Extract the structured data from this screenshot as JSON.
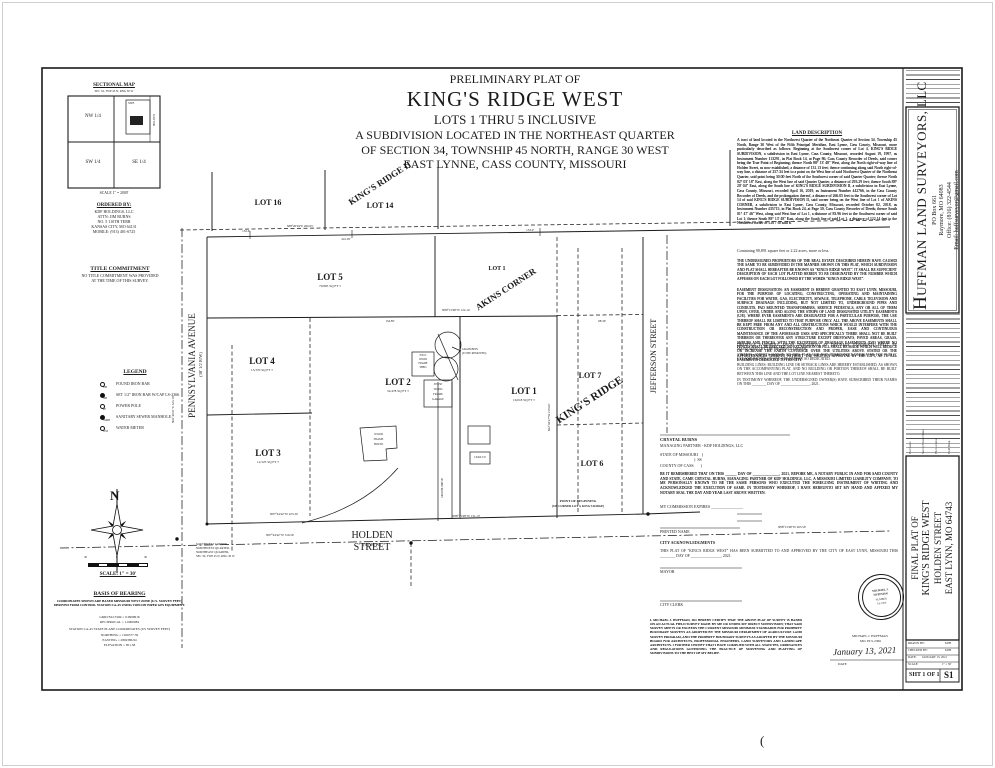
{
  "header": {
    "pre_title": "PRELIMINARY PLAT OF",
    "title": "KING'S RIDGE WEST",
    "lots_line": "LOTS 1 THRU 5 INCLUSIVE",
    "sub1": "A SUBDIVISION LOCATED IN THE NORTHEAST QUARTER",
    "sub2": "OF SECTION 34, TOWNSHIP 45 NORTH, RANGE 30 WEST",
    "sub3": "EAST LYNNE, CASS COUNTY, MISSOURI"
  },
  "sectional_map": {
    "title": "SECTIONAL MAP",
    "subtitle": "SEC 34, TWP 45 N, RNG 30 W",
    "nw": "NW 1/4",
    "sw": "SW 1/4",
    "se": "SE 1/4",
    "site": "SITE",
    "holden": "HOLDEN",
    "scale": "SCALE 1\" = 2000'"
  },
  "ordered_by": {
    "title": "ORDERED BY:",
    "lines": [
      "KDF HOLDINGS, LLC",
      "ATTN: JIM BURNS",
      "NO. 5 110TH TERR",
      "KANSAS CITY, MO 64131",
      "MOBILE: (913) 401-6725"
    ]
  },
  "title_commitment": {
    "title": "TITLE COMMITMENT",
    "line1": "NO TITLE COMMITMENT WAS PROVIDED",
    "line2": "AT THE TIME OF THIS SURVEY."
  },
  "legend": {
    "title": "LEGEND",
    "items": [
      {
        "sym": "FIB",
        "label": "FOUND IRON BAR"
      },
      {
        "sym": "SIB",
        "label": "SET 1/2\" IRON BAR W/CAP LS-2366"
      },
      {
        "sym": "PP",
        "label": "POWER POLE"
      },
      {
        "sym": "SSMH",
        "label": "SANITARY SEWER MANHOLE"
      },
      {
        "sym": "WM",
        "label": "WATER METER"
      }
    ]
  },
  "compass": {
    "north": "N"
  },
  "scale_bar": {
    "left": "30",
    "mid": "0",
    "right": "30",
    "label": "SCALE: 1\" = 30'"
  },
  "basis": {
    "title": "BASIS OF BEARING",
    "p1": "COORDINATES SHOWN ARE BASED MISSOURI WEST ZONE (U.S. SURVEY FEET) DERIVED FROM CONTROL STATION CA-45 USING TOPCON HIPER GPS EQUIPMENT.",
    "grid": "GRID FACTOR = 0.9999916",
    "recip": "RECIPROCAL = 1.0000084",
    "station": "STATION CA-45 STATE PLANE COORDINATES (US SURVEY FEET)",
    "northing": "NORTHING = 1026377.59",
    "easting": "EASTING = 2802386.94",
    "elevation": "ELEVATION = 851.58"
  },
  "plat": {
    "lots": [
      {
        "name": "LOT 16",
        "area": ""
      },
      {
        "name": "LOT 14",
        "area": ""
      },
      {
        "name": "LOT 5",
        "area": "70,895 SQ FT ±"
      },
      {
        "name": "LOT 4",
        "area": "13,370 SQ FT ±"
      },
      {
        "name": "LOT 3",
        "area": "12,325 SQ FT ±"
      },
      {
        "name": "LOT 2",
        "area": "32,478 SQ FT ±"
      },
      {
        "name": "LOT 1",
        "area": "19,018 SQ FT ±"
      },
      {
        "name": "LOT 7",
        "area": ""
      },
      {
        "name": "LOT 6",
        "area": ""
      },
      {
        "name": "LOT 1",
        "area": ""
      }
    ],
    "adjacent": {
      "kings_ridge_2": "KING'S RIDGE II",
      "akins": "AKINS CORNER",
      "kings_ridge": "KING'S RIDGE"
    },
    "streets": {
      "pennsylvania": "PENNSYLVANIA AVENUE",
      "pennsylvania_rw": "(30' 1/2 R/W)",
      "jefferson": "JEFFERSON STREET",
      "holden": "HOLDEN STREET",
      "holden_rw": "(30' R/W)"
    },
    "dimensions": [
      "132.6'",
      "S88°20'04\"E 266.05'",
      "241.05'",
      "153.0'",
      "N89°13'48\"W 122.14'",
      "134.85'",
      "98.36'",
      "N87°44'42\"W 223.34'",
      "N88°13'48\"W 131.13'",
      "N87°44'42\"W 316.56'",
      "N88°13'48\"W 265.56'",
      "N01°40'21\"E 323.10'",
      "S02°04'27\"W 218.00'"
    ],
    "pob1": "POINT OF BEGINNING",
    "pob2": "(SW CORNER LOT 4, KING'S RIDGE)",
    "sw_note": [
      "SOUTHWEST CORNER,",
      "NORTHWEST QUARTER,",
      "NORTHEAST QUARTER,",
      "SEC 34, TWP 45 N, RNG 30 W"
    ],
    "bins_note1": "GRAIN BINS",
    "bins_note2": "(TO BE REMOVED)",
    "shed_note": [
      "8'X10'",
      "WOOD",
      "FRAME",
      "SHED"
    ],
    "garage_note": [
      "30'X50'",
      "WOOD",
      "FRAME",
      "GARAGE"
    ],
    "house_note": [
      "WOOD",
      "FRAME",
      "HOUSE"
    ],
    "leanto": "LEAN-TO",
    "drive": "GRAVEL DRIVE"
  },
  "land_description": {
    "title": "LAND DESCRIPTION",
    "body": "A tract of land located in the Northwest Quarter of the Northeast Quarter of Section 34, Township 45 North, Range 30 West of the Fifth Principal Meridian, East Lynne, Cass County, Missouri, more particularly described as follows: Beginning at the Southwest corner of Lot 4, KING'S RIDGE SUBDIVISION, a subdivision in East Lynne, Cass County, Missouri, recorded August 19, 1997, as Instrument Number 113291, in Plat Book 14, at Page 86, Cass County Recorder of Deeds, said corner being the True Point of Beginning; thence North 88° 13' 48\" West, along the North right-of-way line of Holden Street, as now established, a distance of 131.13 feet; thence continuing along said North right-of-way line, a distance of 257.34 feet to a point on the West line of said Northwest Quarter of the Northeast Quarter, said point being 30.00 feet North of the Southwest corner of said Quarter Quarter; thence North 02° 03' 18\" East, along the West line of said Quarter Quarter, a distance of 293.29 feet; thence South 88° 20' 04\" East, along the South line of KING'S RIDGE SUBDIVISION II, a subdivision in East Lynne, Cass County, Missouri, recorded April 16, 2019, as Instrument Number 442766, in the Cass County Recorder of Deeds, and the prolongation thereof, a distance of 266.05 feet to the Southwest corner of Lot 14 of said KING'S RIDGE SUBDIVISION II, said corner being on the West line of Lot 1 of AKINS CORNER, a subdivision in East Lynne, Cass County, Missouri, recorded October 02, 2018, as Instrument Number 435715, in Plat Book 24, at Page 30, Cass County Recorder of Deeds; thence South 01° 47' 46\" West, along said West line of Lot 1, a distance of 83.96 feet to the Southwest corner of said Lot 1; thence South 88° 13' 48\" East, along the South line of said Lot 1, a distance of 122.14 feet to the Northwest corner of Lot 7 of said K",
    "containing": "Containing 98,891 square feet or 2.22 acres, more or less."
  },
  "certs": {
    "owner": "THE UNDERSIGNED PROPRIETORS OF THE REAL ESTATE DESCRIBED HEREIN HAVE CAUSED THE SAME TO BE SUBDIVIDED IN THE MANNER SHOWN ON THIS PLAT, WHICH SUBDIVISION AND PLAT SHALL HEREAFTER BE KNOWN AS \"KING'S RIDGE WEST\". IT SHALL BE SUFFICIENT DESCRIPTION OF EACH LOT PLATTED HEREIN TO BE DESIGNATED BY THE NUMBER WHICH APPEARS ON EACH LOT FOLLOWED BY THE WORDS \"KING'S RIDGE WEST\".",
    "easement": "EASEMENT DESIGNATION:  AN EASEMENT IS HEREBY GRANTED TO EAST LYNN, MISSOURI, FOR THE PURPOSE OF LOCATING, CONSTRUCTING, OPERATING AND MAINTAINING FACILITIES FOR WATER, GAS, ELECTRICITY, SEWAGE, TELEPHONE, CABLE TELEVISION AND SURFACE DRAINAGE INCLUDING, BUT NOT LIMITED TO, UNDERGROUND PIPES AND CONDUITS, PAD MOUNTED TRANSFORMERS, SERVICE PEDESTALS, ANY OR ALL OF THEM UPON, OVER, UNDER AND ALONG THE STRIPS OF LAND DESIGNATED UTILITY EASEMENTS (U/E). WHERE EVER EASEMENTS ARE DESIGNATED FOR A PARTICULAR PURPOSE, THE USE THEREOF SHALL BE LIMITED TO THAT PURPOSE ONLY. ALL THE ABOVE EASEMENTS SHALL BE KEPT FREE FROM ANY AND ALL OBSTRUCTIONS WHICH WOULD INTERFERE WITH THE CONSTRUCTION OR RECONSTRUCTION AND PROPER, EASE AND CONTINUOUS MAINTENANCE OF THE AFORESAID USES AND SPECIFICALLY THERE SHALL NOT BE BUILT THEREON OR THEREOVER ANY STRUCTURE EXCEPT DRIVEWAYS, PAVED AREAS, GRASS, SHRUBS AND FENCES, WITH THE EXCEPTION OF DRAINAGE EASEMENTS (D/E) WHERE NO FENCES SHALL BE ERECTED. NO EXCAVATION OR FILL SHALL BE MADE WHICH WILL REDUCE OR INCREASE THE EARTH COVERAGE OVER THE UTILITIES ABOVE STATED OR THE APPURTENANCES THERETO WITHOUT THE WRITTEN APPROVAL BY THE CITY, AS TO ALL EASEMENTS DEDICATED TO THE CITY.",
    "drainage": "DRAINAGE EASEMENT:  AREAS DESIGNATED AS DRAINAGE EASEMENTS SHALL BE MAINTAINED BY THE PROPERTY OWNER.",
    "streets": "STREETS:  STREETS SHOWN ON THIS PLAT AND NOT HERETOFORE DEDICATED FOR PUBLIC USE AND RIGHTS OF WAY ARE HEREBY SO DEDICATED.",
    "building": "BUILDING LINES:  BUILDING LINE OR SETBACK LINES ARE HEREBY ESTABLISHED, AS SHOWN ON THE ACCOMPANYING PLAT, AND NO BUILDING OR PORTION THEREOF SHALL BE BUILT BETWEEN THIS LINE AND THE LOT LINE NEAREST THERETO.",
    "testimony": "IN TESTIMONY WHEREOF, THE UNDERSIGNED OWNER(S) HAVE SUBSCRIBED THEIR NAMES ON THIS ________ DAY OF ________________, 2021.",
    "owner_name": "CRYSTAL BURNS",
    "owner_title": "MANAGING PARTNER - KDF HOLDINGS, LLC",
    "state": "STATE OF MISSOURI    )",
    "ss": ")  SS",
    "county": "COUNTY OF CASS       )",
    "notary": "BE IT REMEMBERED THAT ON THIS ______ DAY OF ______________, 2021, BEFORE ME, A NOTARY PUBLIC IN AND FOR SAID COUNTY AND STATE, CAME CRYSTAL BURNS, MANAGING PARTNER OF KDF HOLDINGS, LLC, A MISSOURI LIMITED LIABILITY COMPANY, TO ME PERSONALLY KNOWN TO BE THE SAME PERSONS WHO EXECUTED THE FOREGOING INSTRUMENT OF WRITING AND ACKNOWLEDGED THE EXECUTION OF SAME. IN TESTIMONY WHEREOF, I HAVE HEREUNTO SET MY HAND AND AFFIXED MY NOTARY SEAL THE DAY AND YEAR LAST ABOVE WRITTEN.",
    "commission": "MY COMMISSION EXPIRES ________________",
    "printed_name": "PRINTED NAME",
    "city_ack": "CITY ACKNOWLEDGMENTS",
    "city_approval": "THIS PLAT OF \"KING'S RIDGE WEST\" HAS BEEN SUBMITTED TO AND APPROVED BY THE CITY OF EAST LYNN, MISSOURI THIS ________ DAY OF ________________, 2021.",
    "mayor": "MAYOR",
    "clerk": "CITY CLERK",
    "surveyor": "I, MICHAEL J. HUFFMAN, DO HEREBY CERTIFY THAT THE ABOVE PLAT OF SURVEY IS BASED ON AN ACTUAL FIELD SURVEY MADE BY ME OR UNDER MY DIRECT SUPERVISION; THAT SAID SURVEY MEETS OR EXCEEDS THE CURRENT MISSOURI MINIMUM STANDARDS FOR PROPERTY BOUNDARY SURVEYS AS ADOPTED BY THE MISSOURI DEPARTMENT OF AGRICULTURE LAND SURVEY PROGRAM, AND THE PROPERTY BOUNDARY SURVEYS AS ADOPTED BY THE MISSOURI BOARD FOR ARCHITECTS, PROFESSIONAL ENGINEERS, LAND SURVEYORS AND LANDSCAPE ARCHITECTS. I FURTHER CERTIFY THAT I HAVE COMPLIED WITH ALL STATUTES, ORDINANCES AND REGULATIONS GOVERNING THE PRACTICE OF SURVEYING AND PLATTING OF SUBDIVISIONS TO THE BEST OF MY BELIEF.",
    "seal": [
      "MICHAEL J.",
      "HUFFMAN",
      "NUMBER",
      "LS-2366"
    ],
    "sig_date": "January 13, 2021",
    "sig_name": "MICHAEL J. HUFFMAN",
    "sig_lic": "MO. PLS-2366",
    "date_label": "DATE"
  },
  "title_strip": {
    "firm_initial": "H",
    "firm_rest": "UFFMAN LAND SURVEYORS, LLC",
    "firm_lines": [
      "PO Box 661",
      "Raymore, MO 64083",
      "Office: (816) 322-4544",
      "Email: huffsurveyor@gmail.com"
    ],
    "rev_labels": [
      "Plat Name",
      "Survey/Client Name",
      "File Location",
      "Field Book"
    ],
    "final_plat_lines": [
      "FINAL PLAT OF",
      "KING'S RIDGE WEST",
      "HOLDEN STREET",
      "EAST LYNN, MO 64743"
    ],
    "info_rows": [
      {
        "label": "DRAWN BY:",
        "value": "MJH"
      },
      {
        "label": "CHECKED BY:",
        "value": "MJH"
      },
      {
        "label": "DATE:",
        "value": "JANUARY 13, 2021"
      },
      {
        "label": "SCALE:",
        "value": "1\" = 30'"
      }
    ],
    "sheet": "SHT 1 OF 1",
    "sheet_no": "S1"
  },
  "stray_mark": "("
}
